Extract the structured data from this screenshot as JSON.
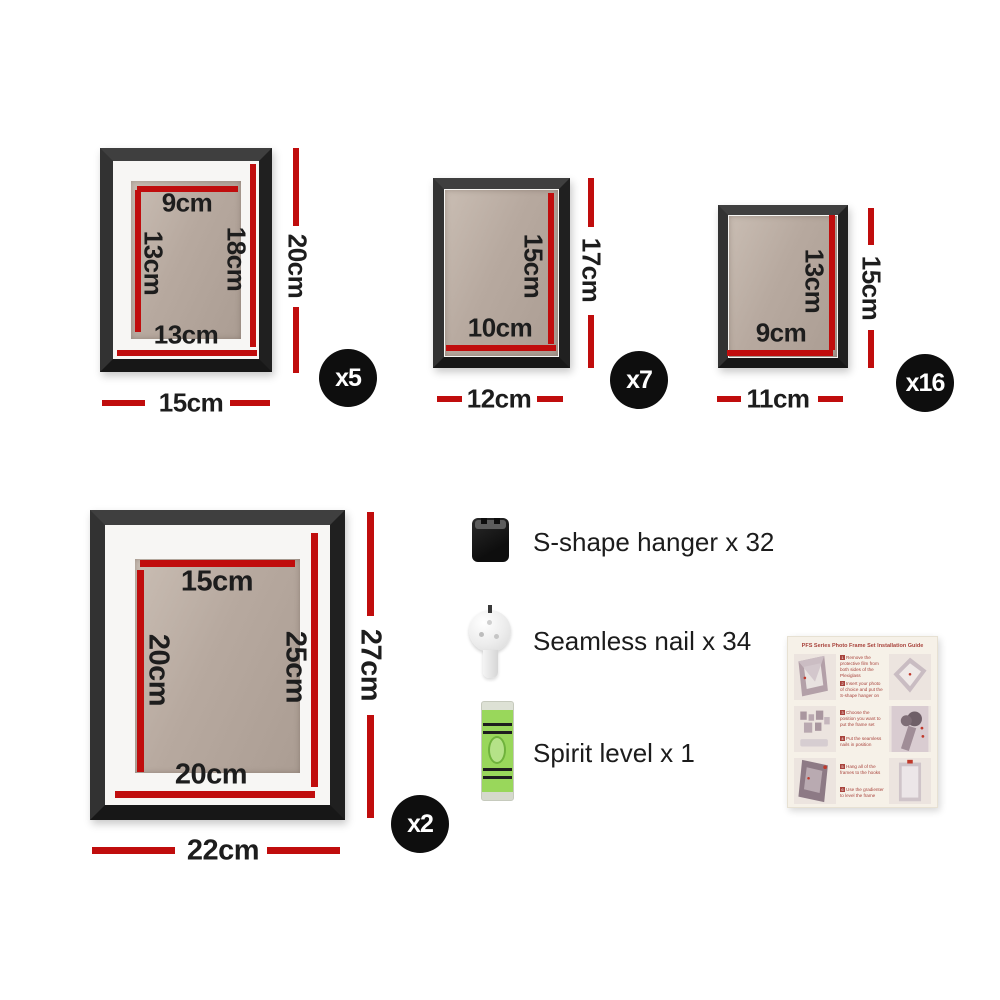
{
  "colors": {
    "accent_red": "#c00d0d",
    "frame_black": "#262626",
    "cardboard": "#b7a99f",
    "mat_white": "#f7f6f4",
    "badge_black": "#0e0e0e",
    "level_green": "#99d75b",
    "guide_red": "#a8433c",
    "guide_card_bg": "#f6f1e8"
  },
  "frames": [
    {
      "qty": "x5",
      "top": "9cm",
      "left": "13cm",
      "right": "18cm",
      "bottom": "13cm",
      "outer_width": "15cm",
      "outer_height": "20cm"
    },
    {
      "qty": "x7",
      "right": "15cm",
      "bottom": "10cm",
      "outer_width": "12cm",
      "outer_height": "17cm"
    },
    {
      "qty": "x16",
      "right": "13cm",
      "bottom": "9cm",
      "outer_width": "11cm",
      "outer_height": "15cm"
    },
    {
      "qty": "x2",
      "top": "15cm",
      "left": "20cm",
      "right": "25cm",
      "bottom": "20cm",
      "outer_width": "22cm",
      "outer_height": "27cm"
    }
  ],
  "accessories": [
    {
      "icon": "s-shape-hanger-icon",
      "label": "S-shape hanger x 32"
    },
    {
      "icon": "seamless-nail-icon",
      "label": "Seamless nail x 34"
    },
    {
      "icon": "spirit-level-icon",
      "label": "Spirit level x 1"
    }
  ],
  "guide": {
    "title": "PFS Series Photo Frame Set Installation Guide",
    "steps": [
      {
        "n": "1",
        "text": "Remove the protective film from both sides of the Plexiglass"
      },
      {
        "n": "2",
        "text": "Insert your photo of choice and put the S-shape hanger on"
      },
      {
        "n": "3",
        "text": "Choose the position you want to put the frame set"
      },
      {
        "n": "4",
        "text": "Put the seamless nails in position"
      },
      {
        "n": "5",
        "text": "Hang all of the frames to the hooks"
      },
      {
        "n": "6",
        "text": "Use the gradienter to level the frame"
      }
    ]
  }
}
